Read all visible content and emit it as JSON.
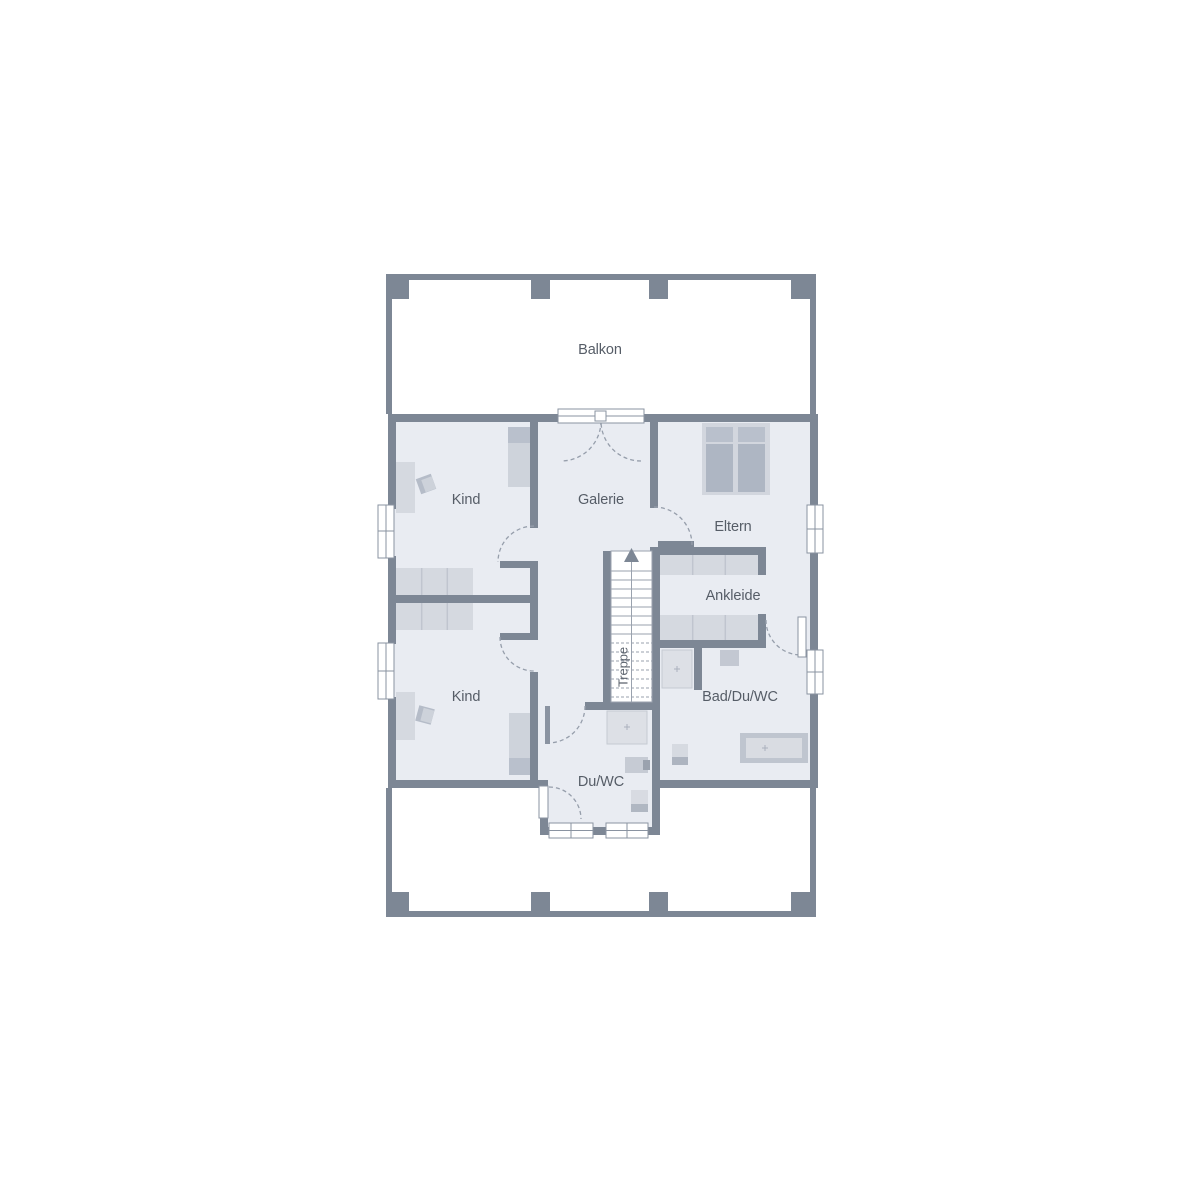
{
  "floor_plan": {
    "labels": [
      {
        "id": "balkon",
        "text": "Balkon"
      },
      {
        "id": "kind-top",
        "text": "Kind"
      },
      {
        "id": "galerie",
        "text": "Galerie"
      },
      {
        "id": "eltern",
        "text": "Eltern"
      },
      {
        "id": "ankleide",
        "text": "Ankleide"
      },
      {
        "id": "bad-du-wc",
        "text": "Bad/Du/WC"
      },
      {
        "id": "kind-bottom",
        "text": "Kind"
      },
      {
        "id": "du-wc",
        "text": "Du/WC"
      },
      {
        "id": "treppe",
        "text": "Treppe"
      }
    ],
    "colors": {
      "background": "#ffffff",
      "wall": "#7d8795",
      "room_fill": "#e9ecf2",
      "furniture_light": "#d5d9e0",
      "furniture_medium": "#c3c8d2",
      "furniture_dark": "#b3bac6",
      "fixture_fill": "#dde0e6",
      "line": "#8a93a1",
      "label_text": "#565d67"
    }
  }
}
